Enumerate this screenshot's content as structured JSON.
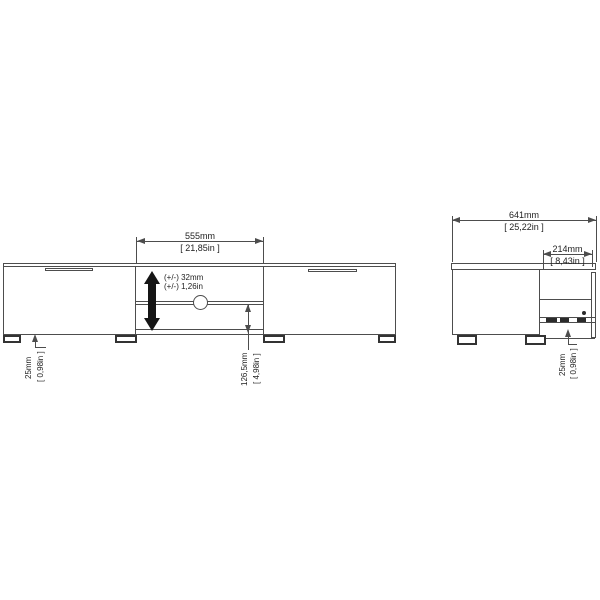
{
  "drawing": {
    "type": "furniture dimension drawing (TV unit, front and side views)",
    "front_view": {
      "width_dim": {
        "mm": "555mm",
        "inches": "[ 21,85in ]"
      },
      "adjust_note": {
        "line1": "(+/-) 32mm",
        "line2": "(+/-) 1,26in"
      },
      "leg_dim": {
        "mm": "25mm",
        "inches": "[ 0,98in ]"
      },
      "shelf_dim": {
        "mm": "126,5mm",
        "inches": "[ 4,98in ]"
      }
    },
    "side_view": {
      "depth_dim": {
        "mm": "641mm",
        "inches": "[ 25,22in ]"
      },
      "back_dim": {
        "mm": "214mm",
        "inches": "[ 8,43in ]"
      },
      "leg_dim": {
        "mm": "25mm",
        "inches": "[ 0,98in ]"
      }
    },
    "colors": {
      "line": "#4d4d4d",
      "text": "#222222",
      "arrow_fill": "#151515",
      "background": "#ffffff"
    }
  }
}
